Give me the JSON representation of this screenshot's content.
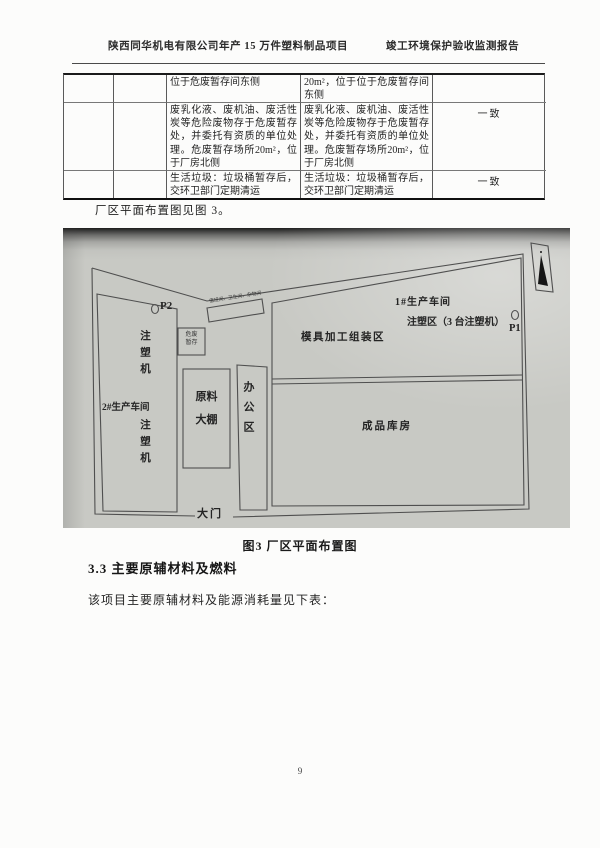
{
  "header": {
    "left": "陕西同华机电有限公司年产 15 万件塑料制品项目",
    "right": "竣工环境保护验收监测报告"
  },
  "table": {
    "rows": [
      {
        "design": "位于危废暂存间东侧",
        "actual": "20m²，位于位于危废暂存间东侧",
        "result": ""
      },
      {
        "design": "废乳化液、废机油、废活性炭等危险废物存于危废暂存处，并委托有资质的单位处理。危废暂存场所20m²，位于厂房北侧",
        "actual": "废乳化液、废机油、废活性炭等危险废物存于危废暂存处，并委托有资质的单位处理。危废暂存场所20m²，位于厂房北侧",
        "result": "一致"
      },
      {
        "design": "生活垃圾：垃圾桶暂存后，交环卫部门定期清运",
        "actual": "生活垃圾：垃圾桶暂存后，交环卫部门定期清运",
        "result": "一致"
      }
    ]
  },
  "intro": "厂区平面布置图见图 3。",
  "figure": {
    "caption": "图3 厂区平面布置图",
    "labels": {
      "workshop1": "1#生产车间",
      "injection_area": "注塑区（3 台注塑机）",
      "p1": "P1",
      "p2": "P2",
      "mold_area": "模具加工组装区",
      "finished_warehouse": "成品库房",
      "workshop2": "2#生产车间",
      "injection_machine_upper": "注塑机",
      "injection_machine_lower": "注塑机",
      "raw_material_line1": "原料",
      "raw_material_line2": "大棚",
      "office": "办公区",
      "gate": "大门",
      "annex_rooms": "值班间、卫生间、杂物间",
      "hazwaste_line1": "危废",
      "hazwaste_line2": "暂存"
    },
    "icons": {
      "north_arrow": "north-arrow-icon"
    }
  },
  "section": {
    "heading": "3.3 主要原辅材料及燃料",
    "body": "该项目主要原辅材料及能源消耗量见下表："
  },
  "page_number": "9",
  "colors": {
    "photo_bg": "#c8c9c4",
    "line": "#4f4f4f",
    "ink": "#1f1f1f"
  }
}
